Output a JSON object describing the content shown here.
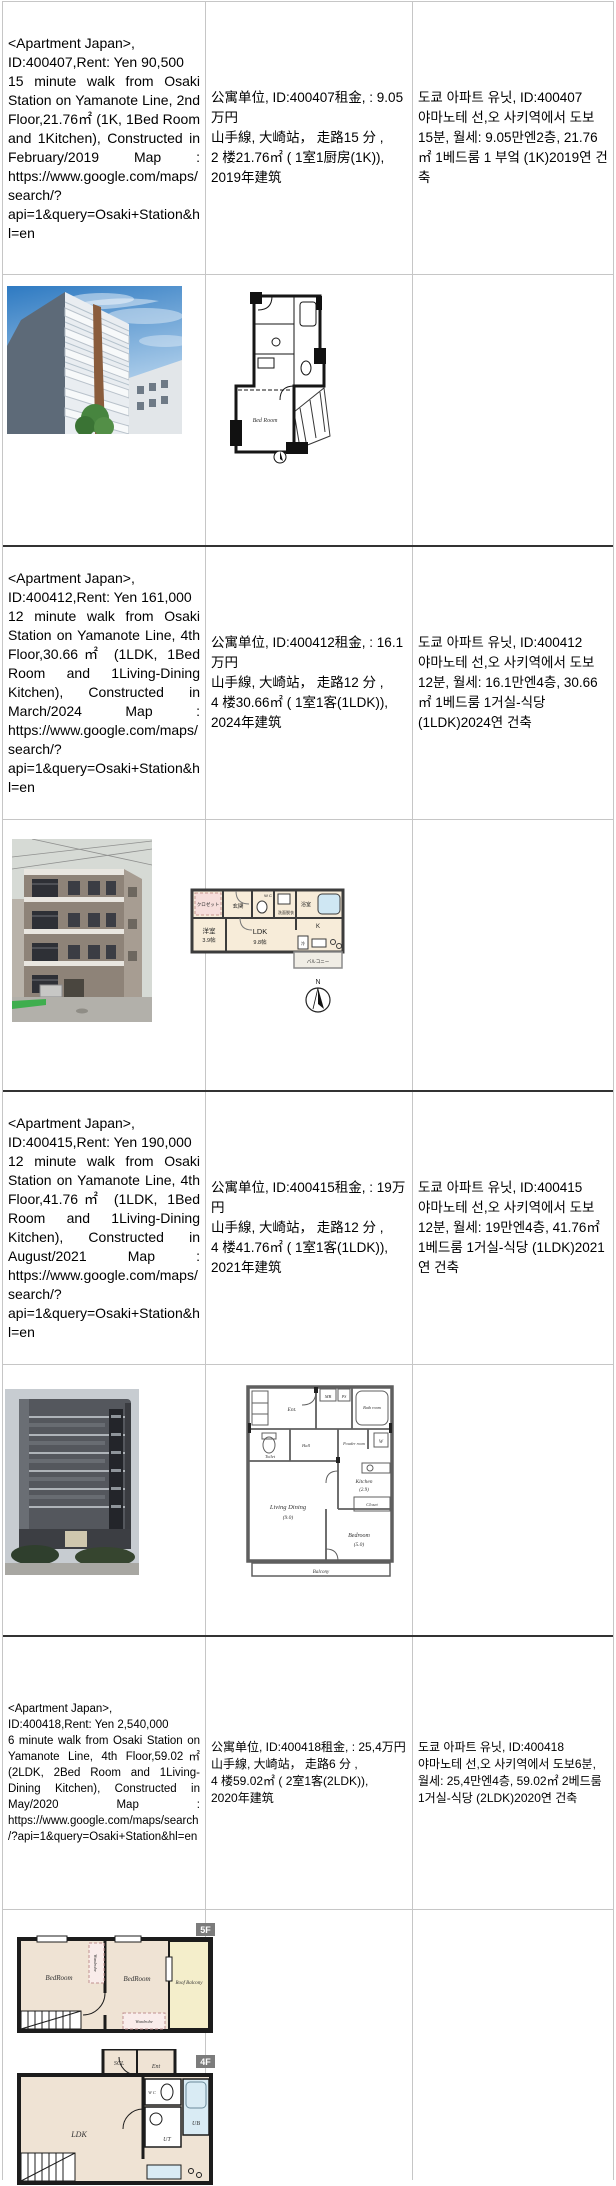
{
  "listings": [
    {
      "en": "<Apartment Japan>,\nID:400407,Rent: Yen 90,500\n15 minute walk from Osaki Station on Yamanote Line, 2nd Floor,21.76㎡ (1K, 1Bed Room and 1Kitchen), Constructed in February/2019 Map : https://www.google.com/maps/search/?api=1&query=Osaki+Station&hl=en",
      "zh": "公寓单位, ID:400407租金, : 9.05万円\n山手線, 大崎站， 走路15 分 ,\n2 楼21.76㎡ ( 1室1厨房(1K)),\n2019年建筑",
      "ko": "도쿄 아파트 유닛, ID:400407\n야마노테 선,오 사키역에서 도보15분, 월세: 9.05만엔2층, 21.76㎡ 1베드룸 1 부엌 (1K)2019연 건축",
      "plan": {
        "bedroom": "Bed Room"
      }
    },
    {
      "en": "<Apartment Japan>,\nID:400412,Rent: Yen 161,000\n12 minute walk from Osaki Station on Yamanote Line, 4th Floor,30.66㎡ (1LDK, 1Bed Room and 1Living-Dining Kitchen), Constructed in March/2024 Map : https://www.google.com/maps/search/?api=1&query=Osaki+Station&hl=en",
      "zh": "公寓单位, ID:400412租金, : 16.1万円\n山手線, 大崎站， 走路12 分 ,\n4 楼30.66㎡ ( 1室1客(1LDK)),\n2024年建筑",
      "ko": "도쿄 아파트 유닛, ID:400412\n야마노테 선,오 사키역에서 도보12분, 월세: 16.1만엔4층, 30.66㎡ 1베드룸 1거실-식당 (1LDK)2024연 건축",
      "plan": {
        "closet": "クロゼット",
        "entrance": "玄関",
        "wc": "W C",
        "washroom": "洗面脱衣",
        "bath": "浴室",
        "western_room": "洋室",
        "western_room_size": "3.9帖",
        "ldk": "LDK",
        "ldk_size": "9.8帖",
        "kitchen": "K",
        "fridge": "冷",
        "balcony": "バルコニー",
        "compass_n": "N"
      }
    },
    {
      "en": "<Apartment Japan>,\nID:400415,Rent: Yen 190,000\n12 minute walk from Osaki Station on Yamanote Line, 4th Floor,41.76㎡ (1LDK, 1Bed Room and 1Living-Dining Kitchen), Constructed in August/2021 Map : https://www.google.com/maps/search/?api=1&query=Osaki+Station&hl=en",
      "zh": "公寓单位, ID:400415租金, : 19万円\n山手線, 大崎站， 走路12 分 ,\n4 楼41.76㎡ ( 1室1客(1LDK)),\n2021年建筑",
      "ko": "도쿄 아파트 유닛, ID:400415\n야마노테 선,오 사키역에서 도보12분, 월세: 19만엔4층, 41.76㎡ 1베드룸 1거실-식당 (1LDK)2021연 건축",
      "plan": {
        "ent": "Ent.",
        "mb": "MB",
        "ps": "PS",
        "bath": "Bath room",
        "toilet": "Toilet",
        "hall": "Hall",
        "powder": "Powder room",
        "w": "W",
        "kitchen": "Kitchen",
        "kitchen_size": "(2.9)",
        "closet": "Closet",
        "living": "Living Dining",
        "living_size": "(9.0)",
        "bedroom": "Bedroom",
        "bedroom_size": "(5.0)",
        "balcony": "Balcony"
      }
    },
    {
      "en": "<Apartment Japan>,\nID:400418,Rent: Yen 2,540,000\n6 minute walk from Osaki Station on Yamanote Line, 4th Floor,59.02㎡ (2LDK, 2Bed Room and 1Living-Dining Kitchen), Constructed in May/2020 Map : https://www.google.com/maps/search/?api=1&query=Osaki+Station&hl=en",
      "zh": "公寓单位, ID:400418租金, : 25,4万円\n山手線, 大崎站， 走路6 分 ,\n4 楼59.02㎡ ( 2室1客(2LDK)),\n2020年建筑",
      "ko": "도쿄 아파트 유닛, ID:400418\n야마노테 선,오 사키역에서 도보6분, 월세: 25,4만엔4층, 59.02㎡ 2베드룸 1거실-식당 (2LDK)2020연 건축",
      "plan5f": {
        "badge": "5F",
        "bedroom1": "BedRoom",
        "bedroom2": "BedRoom",
        "wardrobe1": "Wardrobe",
        "wardrobe2": "Wardrobe",
        "roof_balcony": "Roof Balcony"
      },
      "plan4f": {
        "badge": "4F",
        "scl": "SCL",
        "ent": "Ent",
        "wc": "W C",
        "ut": "UT",
        "ub": "UB",
        "ldk": "LDK"
      }
    }
  ],
  "colors": {
    "border": "#c6c6c6",
    "separator": "#333333",
    "plan_cream": "#f7ecd9",
    "plan_bath_blue": "#cfe7f3",
    "roof_balcony_yellow": "#f4eecb",
    "badge_gray": "#7c7c7c"
  }
}
